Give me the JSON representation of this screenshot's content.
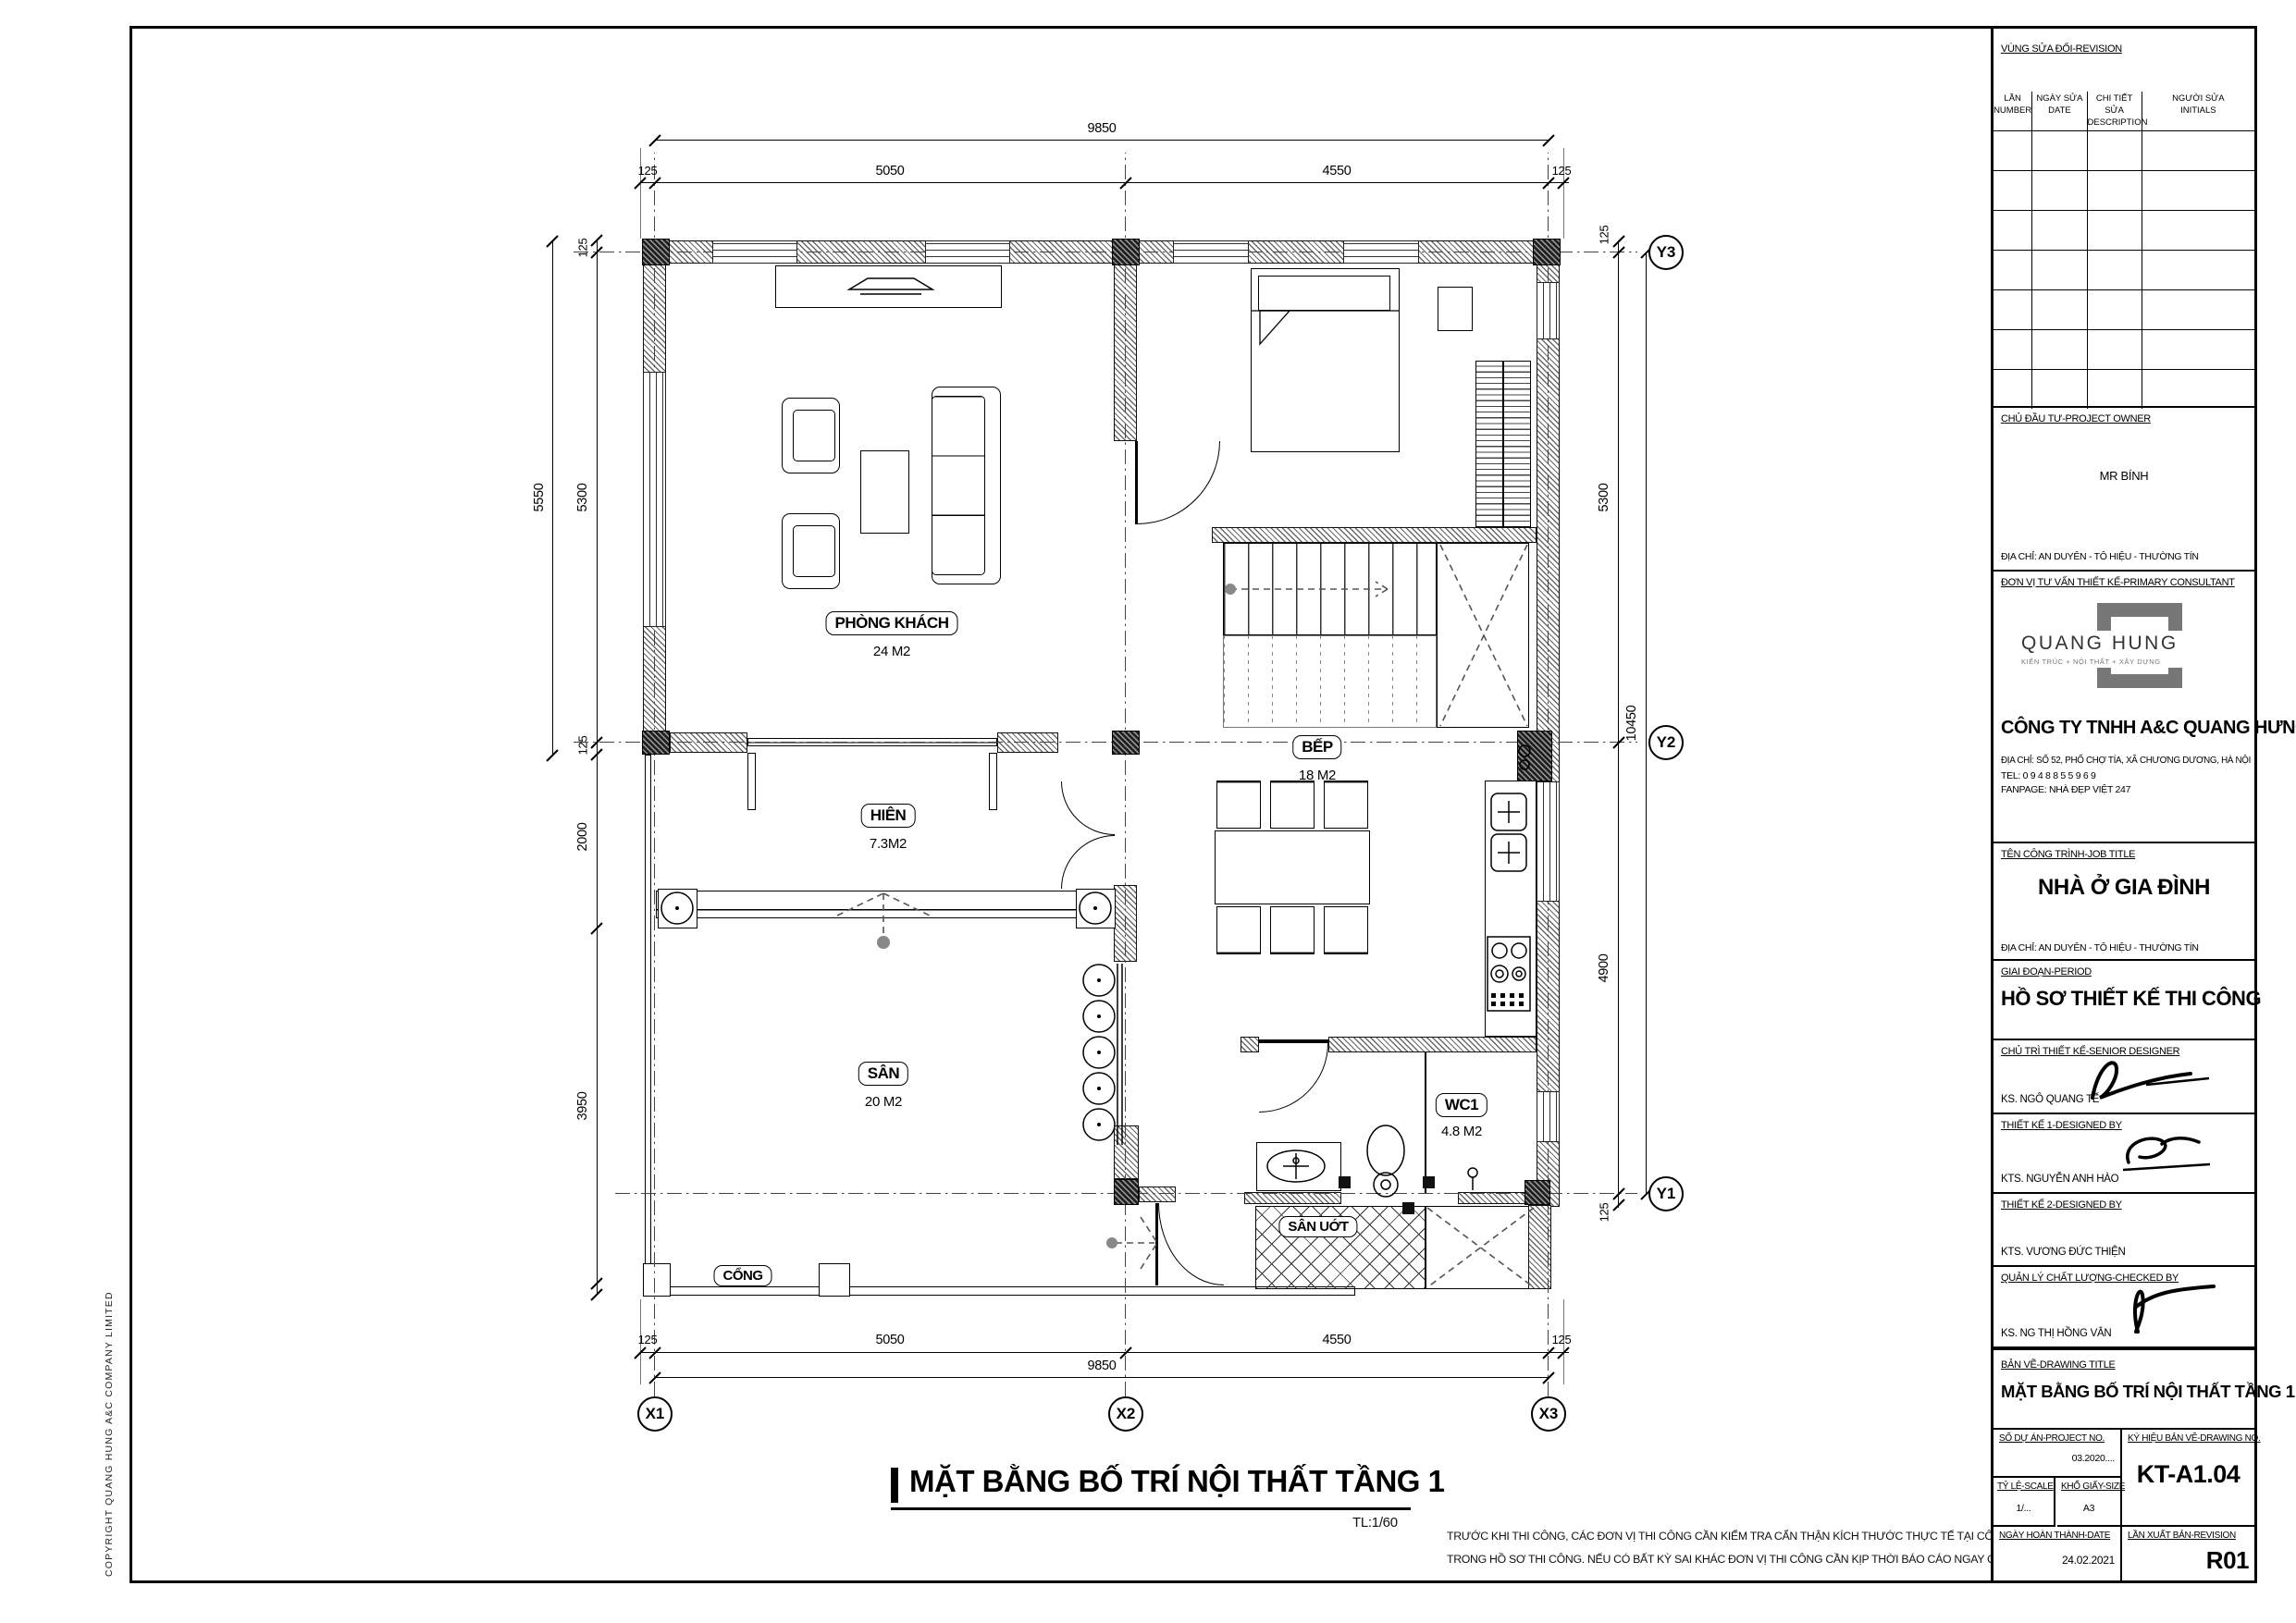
{
  "copyright": "COPYRIGHT QUANG HUNG A&C COMPANY LIMITED",
  "plan": {
    "title": "MẶT BẰNG BỐ TRÍ NỘI THẤT TẦNG 1",
    "scale_note": "TL:1/60",
    "notes": [
      "TRƯỚC KHI THI CÔNG, CÁC ĐƠN VỊ THI CÔNG CẦN KIỂM TRA CẨN THẬN KÍCH THƯỚC THỰC TẾ TẠI CÔNG TRƯỜNG, ĐỐI CHIẾU CÁC BẢN VẼ",
      "TRONG HỒ SƠ THI CÔNG. NẾU CÓ BẤT KỲ SAI KHÁC ĐƠN VỊ THI CÔNG CẦN KỊP THỜI BÁO CÁO NGAY CHO ĐƠN VỊ T/V THIẾT KẾ"
    ],
    "rooms": {
      "living": {
        "name": "PHÒNG KHÁCH",
        "area": "24 M2"
      },
      "porch": {
        "name": "HIÊN",
        "area": "7.3M2"
      },
      "yard": {
        "name": "SÂN",
        "area": "20 M2"
      },
      "kitchen": {
        "name": "BẾP",
        "area": "18 M2"
      },
      "wc": {
        "name": "WC1",
        "area": "4.8 M2"
      },
      "wetyard": {
        "name": "SÂN UỚT"
      },
      "gate": {
        "name": "CỔNG"
      }
    },
    "grid": {
      "x": [
        "X1",
        "X2",
        "X3"
      ],
      "y": [
        "Y3",
        "Y2",
        "Y1"
      ]
    },
    "dims": {
      "top_total": "9850",
      "chain": [
        "125",
        "5050",
        "4550",
        "125"
      ],
      "bottom_total": "9850",
      "left_outer": "5550",
      "left_wall_top": "125",
      "left_mid": "5300",
      "left_wall_bot": "125",
      "left_porch": "2000",
      "left_yard": "3950",
      "right_wall_top": "125",
      "right_upper": "5300",
      "right_lower": "4900",
      "right_wall_bot": "125",
      "right_total": "10450"
    }
  },
  "titleblock": {
    "revision": {
      "title": "VÙNG SỬA ĐỔI-REVISION",
      "columns": [
        {
          "vi": "LẦN",
          "en": "NUMBER"
        },
        {
          "vi": "NGÀY SỬA",
          "en": "DATE"
        },
        {
          "vi": "CHI TIẾT SỬA",
          "en": "DESCRIPTION"
        },
        {
          "vi": "NGƯỜI SỬA",
          "en": "INITIALS"
        }
      ]
    },
    "owner": {
      "label": "CHỦ ĐẦU TƯ-PROJECT OWNER",
      "name": "MR BÍNH",
      "address": "ĐỊA CHỈ: AN DUYÊN - TÔ HIỆU - THƯỜNG TÍN"
    },
    "consultant": {
      "label": "ĐƠN VỊ TƯ VẤN THIẾT KẾ-PRIMARY CONSULTANT",
      "logo_title": "QUANG HUNG",
      "logo_subtitle": "KIẾN TRÚC + NỘI THẤT + XÂY DỰNG",
      "company": "CÔNG TY TNHH A&C QUANG HƯNG",
      "address": "ĐỊA CHỈ: SỐ 52, PHỐ CHỢ TÍA, XÃ CHƯƠNG DƯƠNG, HÀ NỘI",
      "tel": "TEL: 0 9 4 8 8 5 5 9 6 9",
      "fanpage": "FANPAGE: NHÀ ĐẸP VIỆT 247"
    },
    "job": {
      "label": "TÊN CÔNG TRÌNH-JOB TITLE",
      "title": "NHÀ Ở GIA ĐÌNH",
      "address": "ĐỊA CHỈ: AN DUYÊN - TÔ HIỆU - THƯỜNG TÍN"
    },
    "period": {
      "label": "GIAI ĐOẠN-PERIOD",
      "value": "HỒ SƠ THIẾT KẾ THI CÔNG"
    },
    "roles": [
      {
        "label": "CHỦ TRÌ THIẾT KẾ-SENIOR DESIGNER",
        "name": "KS. NGÔ QUANG TẾ"
      },
      {
        "label": "THIẾT KẾ 1-DESIGNED BY",
        "name": "KTS. NGUYỄN ANH HÀO"
      },
      {
        "label": "THIẾT KẾ 2-DESIGNED BY",
        "name": "KTS. VƯƠNG ĐỨC THIỆN"
      },
      {
        "label": "QUẢN LÝ CHẤT LƯỢNG-CHECKED BY",
        "name": "KS. NG THỊ HỒNG VÂN"
      }
    ],
    "drawing": {
      "label": "BẢN VẼ-DRAWING TITLE",
      "title": "MẶT BẰNG BỐ TRÍ NỘI THẤT TẦNG 1"
    },
    "meta": {
      "project_label": "SỐ DỰ ÁN-PROJECT NO.",
      "project_no": "03.2020....",
      "scale_label": "TỶ LỆ-SCALE",
      "scale": "1/...",
      "size_label": "KHỔ GIẤY-SIZE",
      "size": "A3",
      "date_label": "NGÀY HOÀN THÀNH-DATE",
      "date": "24.02.2021",
      "drawno_label": "KÝ HIỆU BẢN VẼ-DRAWING NO.",
      "drawno": "KT-A1.04",
      "rev_label": "LẦN XUẤT BẢN-REVISION",
      "rev": "R01"
    }
  }
}
